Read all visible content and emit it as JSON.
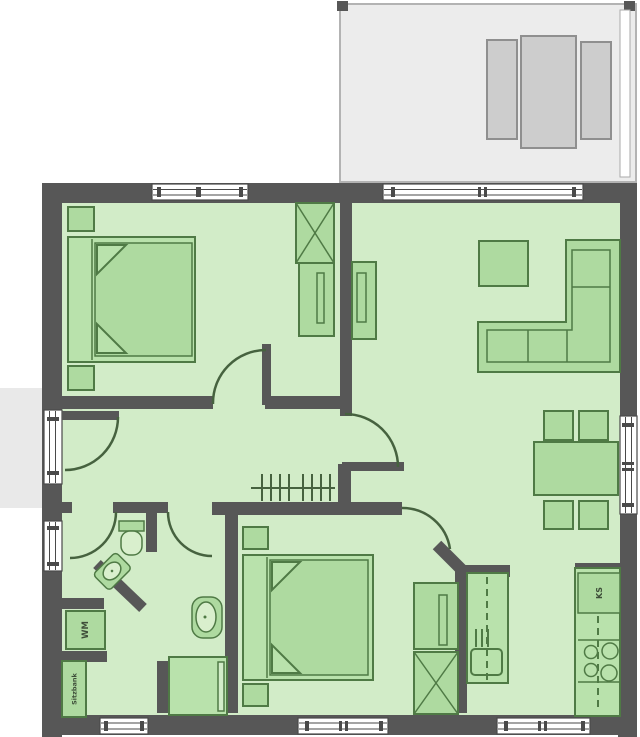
{
  "labels": {
    "washing_machine": "WM",
    "bench": "Sitzbank",
    "fridge": "KS"
  },
  "colors": {
    "wall": "#575757",
    "floor": "#d2ecc8",
    "furn_fill": "#aedaa0",
    "furn_stroke": "#4f7a45",
    "bed": "#b9e2ac",
    "bowl": "#d9efcd",
    "door": "#46623f",
    "terrace": "#ececec",
    "terrace_furn": "#cdcdcd",
    "terrace_stroke": "#8f8f8f",
    "porch": "#e9e9e9",
    "window_frame": "#4a4a4a",
    "label_text": "#3e4e39"
  }
}
